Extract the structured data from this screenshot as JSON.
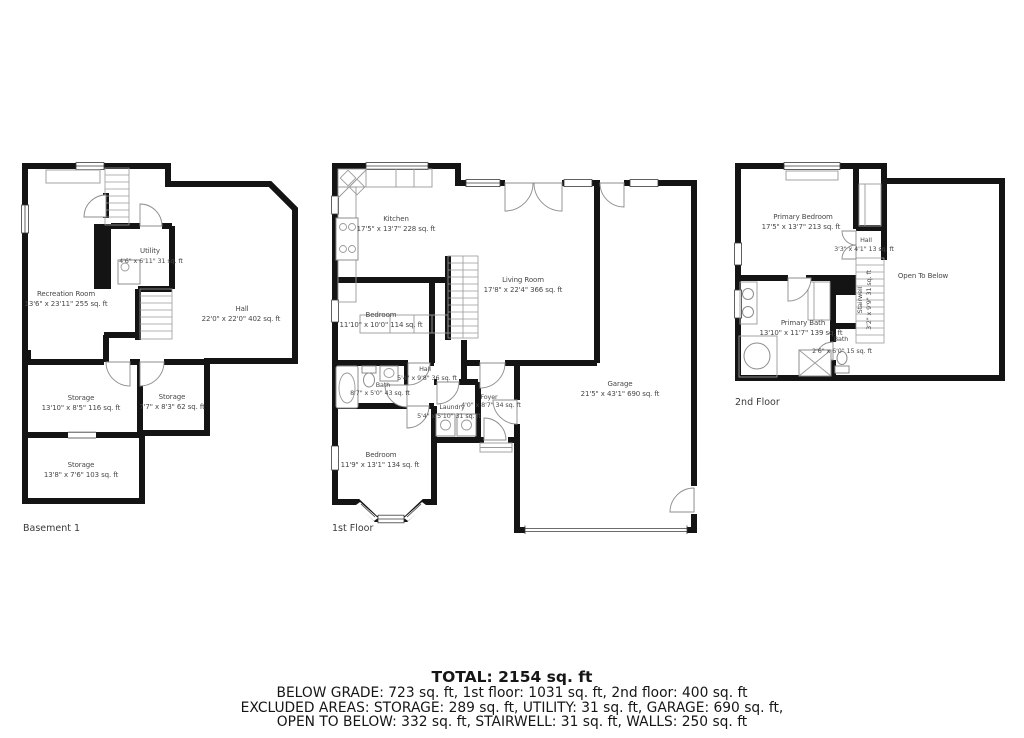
{
  "colors": {
    "wall": "#141414",
    "door_arc": "#8c8c8c",
    "window_line": "#3a3a3a",
    "room_text": "#474747",
    "summary_text": "#161616",
    "background": "#ffffff"
  },
  "floors": {
    "basement": {
      "name": "Basement 1",
      "rooms": {
        "recreation": {
          "label": "Recreation Room",
          "dims": "13'6\" x 23'11\" 255 sq. ft"
        },
        "utility": {
          "label": "Utility",
          "dims": "4'6\" x 6'11\" 31 sq. ft"
        },
        "hall": {
          "label": "Hall",
          "dims": "22'0\" x 22'0\" 402 sq. ft"
        },
        "storage1": {
          "label": "Storage",
          "dims": "13'10\" x 8'5\" 116 sq. ft"
        },
        "storage2": {
          "label": "Storage",
          "dims": "7'7\" x 8'3\" 62 sq. ft"
        },
        "storage3": {
          "label": "Storage",
          "dims": "13'8\" x 7'6\" 103 sq. ft"
        }
      }
    },
    "first": {
      "name": "1st Floor",
      "rooms": {
        "kitchen": {
          "label": "Kitchen",
          "dims": "17'5\" x 13'7\" 228 sq. ft"
        },
        "living_room": {
          "label": "Living Room",
          "dims": "17'8\" x 22'4\" 366 sq. ft"
        },
        "bedroom_mid": {
          "label": "Bedroom",
          "dims": "11'10\" x 10'0\" 114 sq. ft"
        },
        "bath": {
          "label": "Bath",
          "dims": "8'7\" x 5'0\" 43 sq. ft"
        },
        "hall": {
          "label": "Hall",
          "dims": "5'4\" x 9'8\" 36 sq. ft"
        },
        "laundry": {
          "label": "Laundry",
          "dims": "5'4\" x 5'10\" 31 sq. ft"
        },
        "foyer": {
          "label": "Foyer",
          "dims": "4'0\" x 8'7\" 34 sq. ft"
        },
        "bedroom_front": {
          "label": "Bedroom",
          "dims": "11'9\" x 13'1\" 134 sq. ft"
        },
        "garage": {
          "label": "Garage",
          "dims": "21'5\" x 43'1\" 690 sq. ft"
        }
      }
    },
    "second": {
      "name": "2nd Floor",
      "rooms": {
        "primary_bedroom": {
          "label": "Primary Bedroom",
          "dims": "17'5\" x 13'7\" 213 sq. ft"
        },
        "hall": {
          "label": "Hall",
          "dims": "3'3\" x 4'1\" 13 sq. ft"
        },
        "stairwell": {
          "label": "Stairwell",
          "dims": "3'2\" x 9'9\" 31 sq. ft"
        },
        "primary_bath": {
          "label": "Primary Bath",
          "dims": "13'10\" x 11'7\" 139 sq. ft"
        },
        "bath": {
          "label": "Bath",
          "dims": "2'6\" x 6'0\" 15 sq. ft"
        },
        "open_to_below": {
          "label": "Open To Below"
        }
      }
    }
  },
  "summary": {
    "total": "TOTAL: 2154 sq. ft",
    "by_floor": "BELOW GRADE: 723 sq. ft, 1st floor: 1031 sq. ft, 2nd floor: 400 sq. ft",
    "excluded_1": "EXCLUDED AREAS: STORAGE: 289 sq. ft, UTILITY: 31 sq. ft, GARAGE: 690 sq. ft,",
    "excluded_2": "OPEN TO BELOW: 332 sq. ft, STAIRWELL: 31 sq. ft, WALLS: 250 sq. ft"
  }
}
